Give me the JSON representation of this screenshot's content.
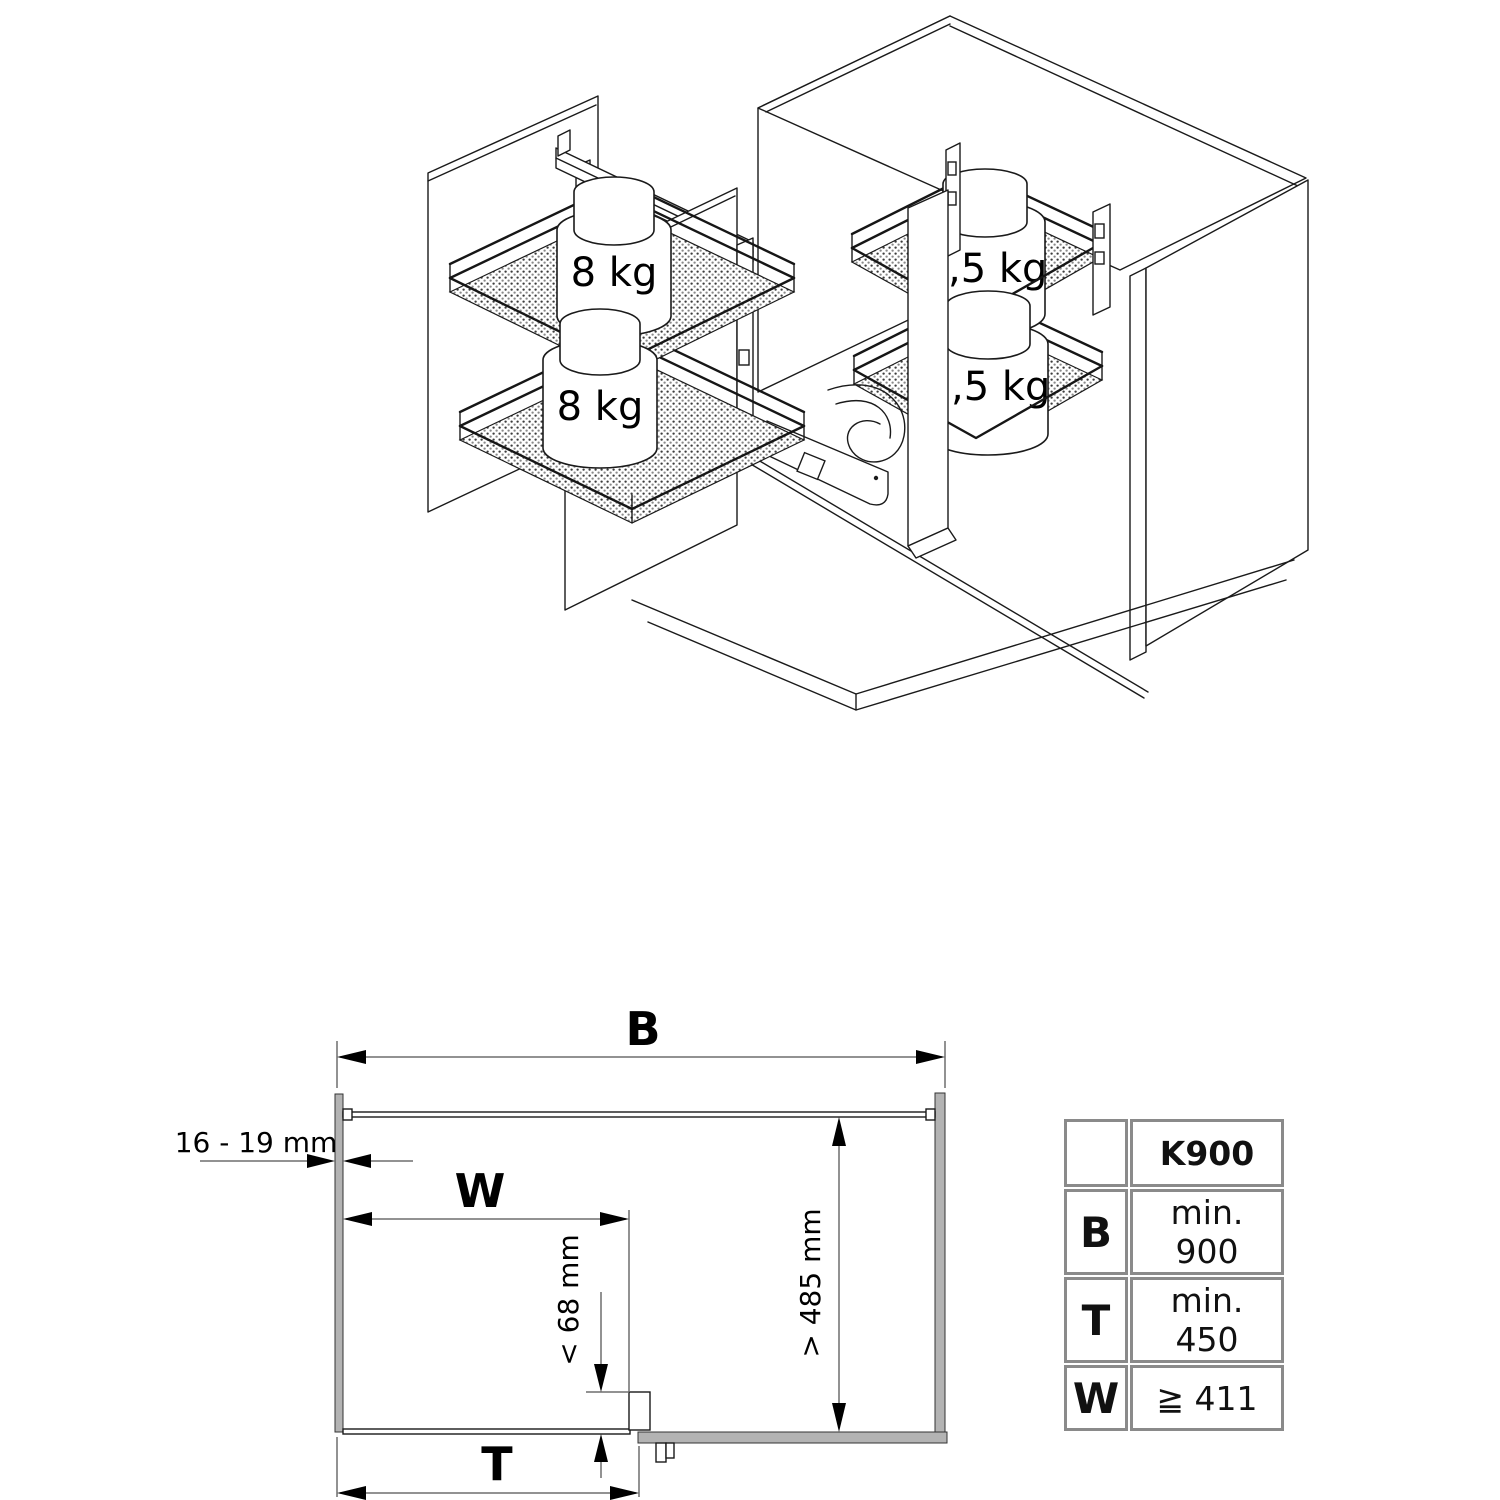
{
  "illustration": {
    "description": "isometric drawing of corner cabinet pull-out with wire baskets",
    "jar_labels": {
      "left_top": "8 kg",
      "left_bottom": "8 kg",
      "right_top": "9,5 kg",
      "right_bottom": "9,5 kg"
    }
  },
  "plan": {
    "labels": {
      "width_total": "B",
      "pullout_width": "W",
      "depth": "T"
    },
    "annotations": {
      "panel_thickness": "16 - 19 mm",
      "hinge_clearance": "< 68 mm",
      "min_inner_depth": "> 485 mm"
    }
  },
  "spec_table": {
    "model": "K900",
    "rows": [
      {
        "param": "B",
        "value": "min. 900"
      },
      {
        "param": "T",
        "value": "min. 450"
      },
      {
        "param": "W",
        "value": "≧ 411"
      }
    ]
  },
  "colors": {
    "wall_fill": "#b3b3b3",
    "table_border": "#8a8a8a",
    "line": "#1a1a1a",
    "dim_line": "#6e6e6e"
  }
}
